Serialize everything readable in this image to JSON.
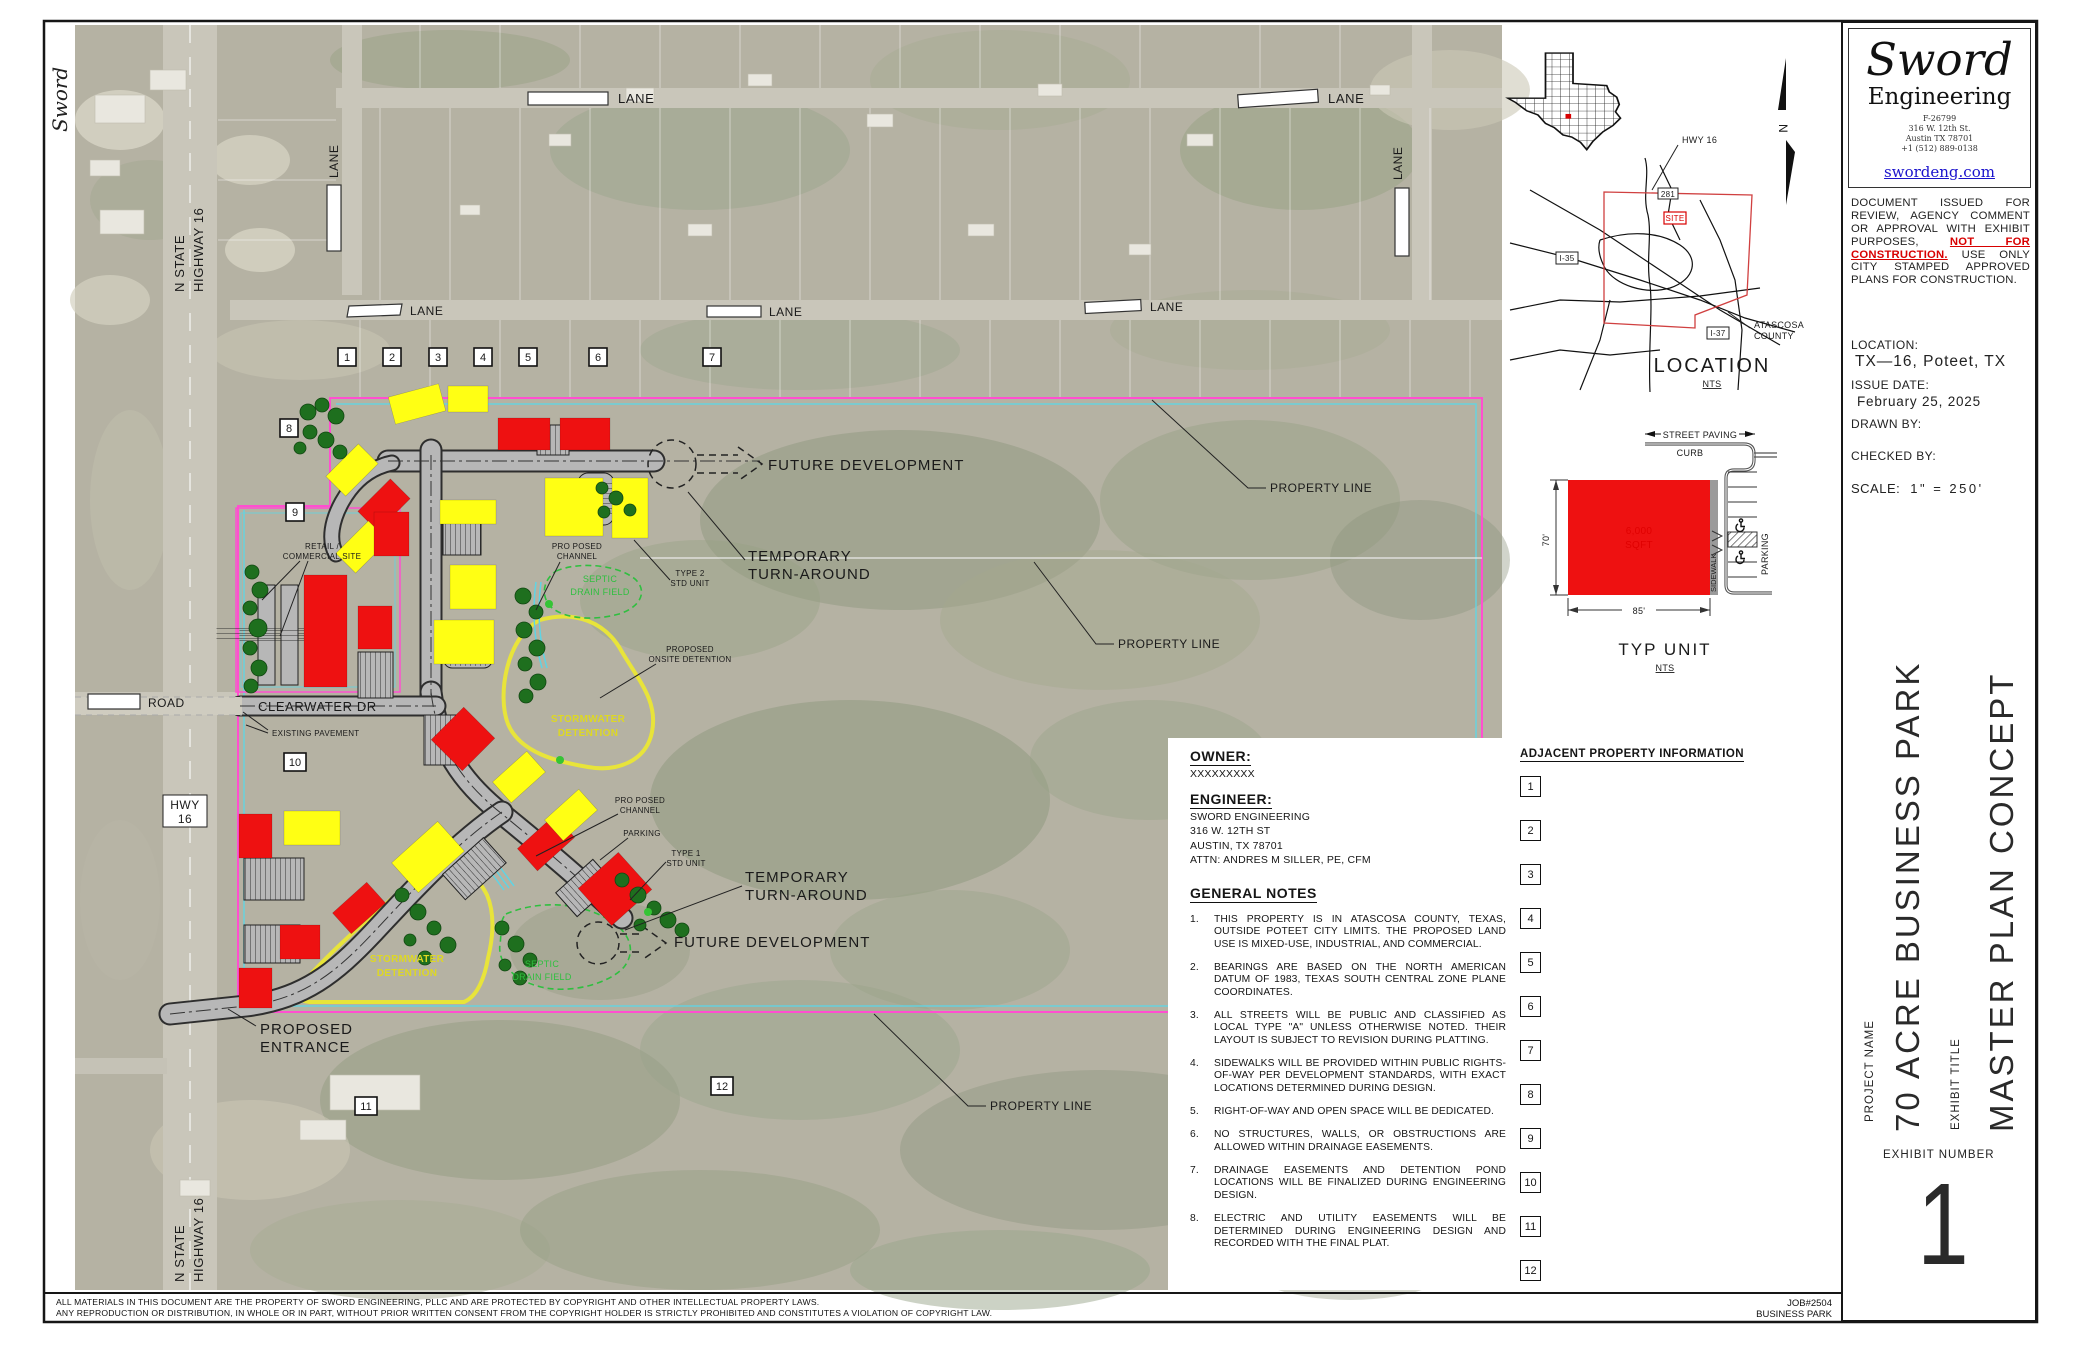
{
  "sheet": {
    "margin_brand": "Sword",
    "copyright_line1": "ALL MATERIALS IN THIS DOCUMENT ARE THE PROPERTY OF SWORD ENGINEERING, PLLC AND ARE PROTECTED BY COPYRIGHT AND OTHER INTELLECTUAL PROPERTY LAWS.",
    "copyright_line2": "ANY REPRODUCTION OR DISTRIBUTION, IN WHOLE OR IN PART, WITHOUT PRIOR WRITTEN CONSENT FROM THE COPYRIGHT HOLDER IS STRICTLY PROHIBITED AND CONSTITUTES A VIOLATION OF COPYRIGHT LAW.",
    "job_number": "JOB#2504",
    "job_name": "BUSINESS PARK"
  },
  "title_block": {
    "logo_title": "Sword",
    "logo_subtitle": "Engineering",
    "firm_number": "F-26799",
    "address_line1": "316 W. 12th St.",
    "address_line2": "Austin TX 78701",
    "phone": "+1 (512) 889-0138",
    "website": "swordeng.com",
    "notice_pre": "DOCUMENT ISSUED FOR REVIEW, AGENCY COMMENT OR APPROVAL WITH EXHIBIT PURPOSES, ",
    "notice_highlight": "NOT FOR CONSTRUCTION.",
    "notice_post": " USE ONLY CITY STAMPED APPROVED PLANS FOR CONSTRUCTION.",
    "location_label": "LOCATION:",
    "location_value": "TX—16, Poteet, TX",
    "issue_date_label": "ISSUE DATE:",
    "issue_date_value": "February 25, 2025",
    "drawn_by_label": "DRAWN BY:",
    "checked_by_label": "CHECKED BY:",
    "scale_label": "SCALE:",
    "scale_value": "1\" = 250'",
    "project_name_label": "PROJECT NAME",
    "project_name": "70 ACRE BUSINESS PARK",
    "exhibit_title_label": "EXHIBIT TITLE",
    "exhibit_title": "MASTER PLAN CONCEPT",
    "exhibit_number_label": "EXHIBIT NUMBER",
    "exhibit_number": "1"
  },
  "location_inset": {
    "hwy16": "HWY 16",
    "route281": "281",
    "site": "SITE",
    "i35": "I-35",
    "i37": "I-37",
    "county_line1": "ATASCOSA",
    "county_line2": "COUNTY",
    "title": "LOCATION",
    "nts": "NTS",
    "north": "N"
  },
  "typ_unit": {
    "street_paving": "STREET PAVING",
    "curb": "CURB",
    "area_line1": "6,000",
    "area_line2": "SQFT",
    "depth": "70'",
    "width": "85'",
    "sidewalk": "SIDEWALK",
    "parking": "PARKING",
    "title": "TYP UNIT",
    "nts": "NTS"
  },
  "notes_panel": {
    "owner_label": "OWNER:",
    "owner_value": "XXXXXXXXX",
    "engineer_label": "ENGINEER:",
    "engineer_lines": [
      "SWORD ENGINEERING",
      "316 W. 12TH ST",
      "AUSTIN, TX 78701",
      "ATTN:  ANDRES M SILLER, PE, CFM"
    ],
    "general_notes_label": "GENERAL NOTES",
    "notes": [
      {
        "num": "1.",
        "text": "THIS PROPERTY IS IN ATASCOSA COUNTY, TEXAS, OUTSIDE POTEET CITY LIMITS. THE PROPOSED LAND USE IS MIXED-USE, INDUSTRIAL, AND COMMERCIAL."
      },
      {
        "num": "2.",
        "text": "BEARINGS ARE BASED ON THE NORTH AMERICAN DATUM OF 1983, TEXAS SOUTH CENTRAL ZONE PLANE COORDINATES."
      },
      {
        "num": "3.",
        "text": "ALL STREETS WILL BE PUBLIC AND CLASSIFIED AS LOCAL TYPE \"A\" UNLESS OTHERWISE NOTED. THEIR LAYOUT IS SUBJECT TO REVISION DURING PLATTING."
      },
      {
        "num": "4.",
        "text": "SIDEWALKS WILL BE PROVIDED WITHIN PUBLIC RIGHTS-OF-WAY PER DEVELOPMENT STANDARDS, WITH EXACT LOCATIONS DETERMINED DURING DESIGN."
      },
      {
        "num": "5.",
        "text": "RIGHT-OF-WAY AND OPEN SPACE WILL BE DEDICATED."
      },
      {
        "num": "6.",
        "text": "NO STRUCTURES, WALLS, OR OBSTRUCTIONS ARE ALLOWED WITHIN DRAINAGE EASEMENTS."
      },
      {
        "num": "7.",
        "text": "DRAINAGE EASEMENTS AND DETENTION POND LOCATIONS WILL BE FINALIZED DURING ENGINEERING DESIGN."
      },
      {
        "num": "8.",
        "text": "ELECTRIC AND UTILITY EASEMENTS WILL BE DETERMINED DURING ENGINEERING DESIGN AND RECORDED WITH THE FINAL PLAT."
      }
    ],
    "adjacent_label": "ADJACENT PROPERTY INFORMATION",
    "adjacent_ids": [
      "1",
      "2",
      "3",
      "4",
      "5",
      "6",
      "7",
      "8",
      "9",
      "10",
      "11",
      "12"
    ]
  },
  "plan": {
    "labels": {
      "future_development": "FUTURE DEVELOPMENT",
      "temporary_line1": "TEMPORARY",
      "temporary_line2": "TURN-AROUND",
      "property_line": "PROPERTY LINE",
      "stormwater_line1": "STORMWATER",
      "stormwater_line2": "DETENTION",
      "septic_line1": "SEPTIC",
      "septic_line2": "DRAIN FIELD",
      "channel_line1": "PRO POSED",
      "channel_line2": "CHANNEL",
      "onsite_line1": "PROPOSED",
      "onsite_line2": "ONSITE DETENTION",
      "type2_line1": "TYPE 2",
      "type2_line2": "STD UNIT",
      "type1_line1": "TYPE 1",
      "type1_line2": "STD UNIT",
      "parking": "PARKING",
      "retail_line1": "RETAIL /",
      "retail_line2": "COMMERCIAL SITE",
      "clearwater": "CLEARWATER DR",
      "existing_pavement": "EXISTING PAVEMENT",
      "entrance_line1": "PROPOSED",
      "entrance_line2": "ENTRANCE",
      "lane": "LANE",
      "road": "ROAD",
      "hwy_line1": "HWY",
      "hwy_line2": "16",
      "n_state_line1": "N STATE",
      "n_state_line2": "HIGHWAY 16"
    },
    "markers": [
      "1",
      "2",
      "3",
      "4",
      "5",
      "6",
      "7",
      "8",
      "9",
      "10",
      "11",
      "12"
    ]
  },
  "colors": {
    "building_red": "#ee1111",
    "building_yellow": "#ffff14",
    "property_line_pink": "#ff4fd0",
    "channel_cyan": "#5fd4e4",
    "detention_yellow": "#e8e43a",
    "septic_green": "#2fbf3f",
    "tree_green": "#1e6f1e",
    "not_for_construction_red": "#d80000",
    "link_blue": "#1a12cc"
  }
}
